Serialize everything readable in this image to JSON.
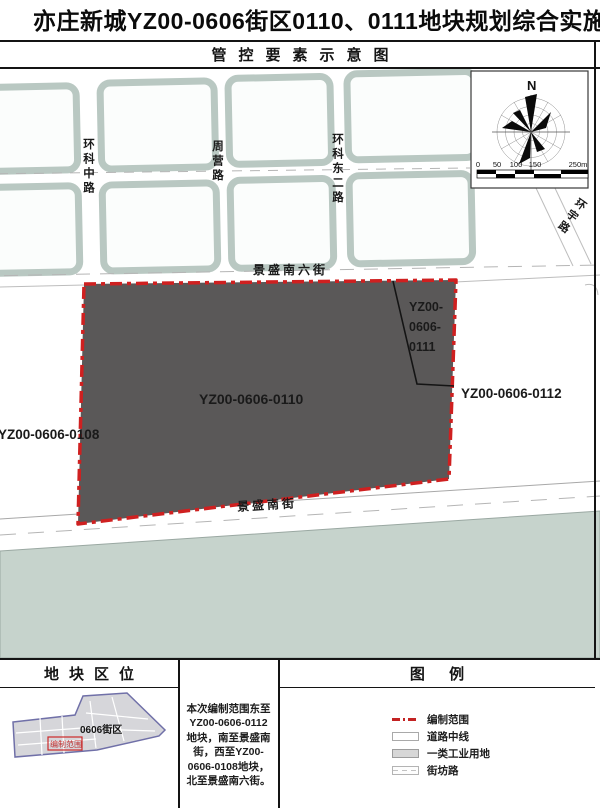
{
  "page": {
    "title": "亦庄新城YZ00-0606街区0110、0111地块规划综合实施方案",
    "subtitle": "管控要素示意图"
  },
  "map": {
    "compass": {
      "north_label": "N"
    },
    "scale_bar": {
      "ticks": [
        "0",
        "50",
        "100",
        "150",
        "250m"
      ]
    },
    "roads": {
      "huanke_middle_road": "环科中路",
      "zhouying_road": "周营路",
      "huanke_east2_road": "环科东二路",
      "huanyu_road": "环宇路",
      "jingsheng_south6_street": "景盛南六街",
      "jingsheng_south_street": "景盛南街"
    },
    "parcels": {
      "main_parcel": "YZ00-0606-0110",
      "sub_parcel_lines": [
        "YZ00-",
        "0606-",
        "0111"
      ],
      "east_parcel": "YZ00-0606-0112",
      "west_parcel": "YZ00-0606-0108"
    }
  },
  "footer": {
    "location": {
      "title": "地块区位",
      "district_label": "0606街区",
      "scope_label": "编制范围"
    },
    "description": {
      "lines": [
        "本次编制范围东至",
        "YZ00-0606-0112",
        "地块，南至景盛南",
        "街，西至YZ00-",
        "0606-0108地块，",
        "北至景盛南六街。"
      ]
    },
    "legend": {
      "title": "图 例",
      "items": [
        {
          "label": "编制范围"
        },
        {
          "label": "道路中线"
        },
        {
          "label": "一类工业用地"
        },
        {
          "label": "街坊路"
        }
      ]
    }
  },
  "colors": {
    "scope_red": "#cf2020",
    "industrial_parcel_dark": "#5a5858",
    "legend_industrial_gray": "#d7d7d7",
    "green_area": "#c6d3cc",
    "block_border": "#b9c8c2",
    "district_outline": "#7070a8"
  }
}
